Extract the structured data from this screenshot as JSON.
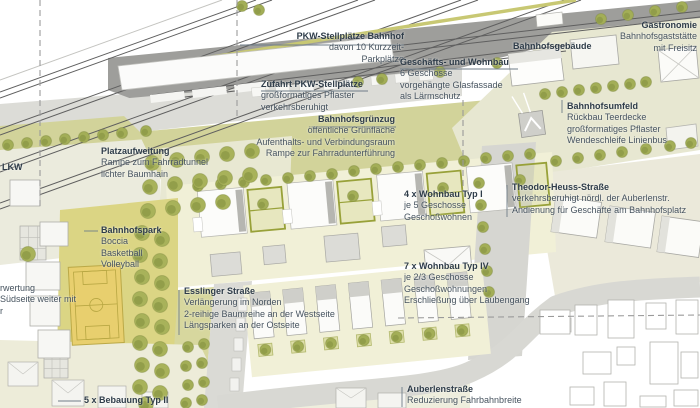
{
  "plan": {
    "palette": {
      "rail_line": "#5f5f5f",
      "parking_gray": "#9e9e9b",
      "street_gray": "#d8d8d3",
      "green_strip": "#d2d39a",
      "park_green": "#dbd584",
      "court_yellow": "#e8cf6e",
      "tree_green": "#a3ae57",
      "hedge_green": "#98a139",
      "block_cream": "#f1f0d7",
      "plaza_pale": "#e7e7d1",
      "label_text": "#46535f",
      "label_bold": "#2e3c49"
    }
  },
  "labels": {
    "pkw": {
      "lines": [
        "PKW-Stellplätze Bahnhof",
        "davon 10 Kurzzeit-",
        "Parkplätze"
      ]
    },
    "zufahrt": {
      "lines": [
        "Zufahrt PKW-Stellplätze",
        "großformatiges Pflaster",
        "verkehrsberuhigt"
      ]
    },
    "geschaefts": {
      "lines": [
        "Geschäfts- und Wohnbau",
        "6 Geschosse",
        "vorgehängte Glasfassade",
        "als Lärmschutz"
      ]
    },
    "gebaeude": {
      "lines": [
        "Bahnhofsgebäude"
      ]
    },
    "gastronomie": {
      "lines": [
        "Gastronomie",
        "Bahnhofsgaststätte",
        "mit Freisitz"
      ]
    },
    "gruenzug": {
      "lines": [
        "Bahnhofsgrünzug",
        "öffentliche Grünfläche",
        "Aufenthalts- und Verbindungsraum",
        "Rampe zur Fahrradunterführung"
      ]
    },
    "umfeld": {
      "lines": [
        "Bahnhofsumfeld",
        "Rückbau Teerdecke",
        "großformatiges Pflaster",
        "Wendeschleife Linienbus"
      ]
    },
    "heuss": {
      "lines": [
        "Theodor-Heuss-Straße",
        "verkehrsberuhigt nördl. der Auberlenstr.",
        "Andienung für Geschäfte am Bahnhofsplatz"
      ]
    },
    "typ1": {
      "lines": [
        "4 x Wohnbau Typ I",
        "je 5 Geschosse",
        "Geschoßwohnen"
      ]
    },
    "platz": {
      "lines": [
        "Platzaufweitung",
        "Rampe zum Fahrradtunnel",
        "lichter Baumhain"
      ]
    },
    "lkw": {
      "lines": [
        "LKW"
      ]
    },
    "park": {
      "lines": [
        "Bahnhofspark",
        "Boccia",
        "Basketball",
        "Volleyball"
      ]
    },
    "leftclip": {
      "lines": [
        "rwertung",
        "Südseite weiter mit",
        "r"
      ]
    },
    "esslinger": {
      "lines": [
        "Esslinger Straße",
        "Verlängerung im Norden",
        "2-reihige Baumreihe an der Westseite",
        "Längsparken an der Ostseite"
      ]
    },
    "typ4": {
      "lines": [
        "7 x Wohnbau Typ IV",
        "je 2/3 Geschosse",
        "Geschoßwohnungen",
        "Erschließung über Laubengang"
      ]
    },
    "auberlen": {
      "lines": [
        "Auberlenstraße",
        "Reduzierung Fahrbahnbreite"
      ]
    },
    "typ2": {
      "lines": [
        "5 x Bebauung Typ II"
      ]
    }
  }
}
